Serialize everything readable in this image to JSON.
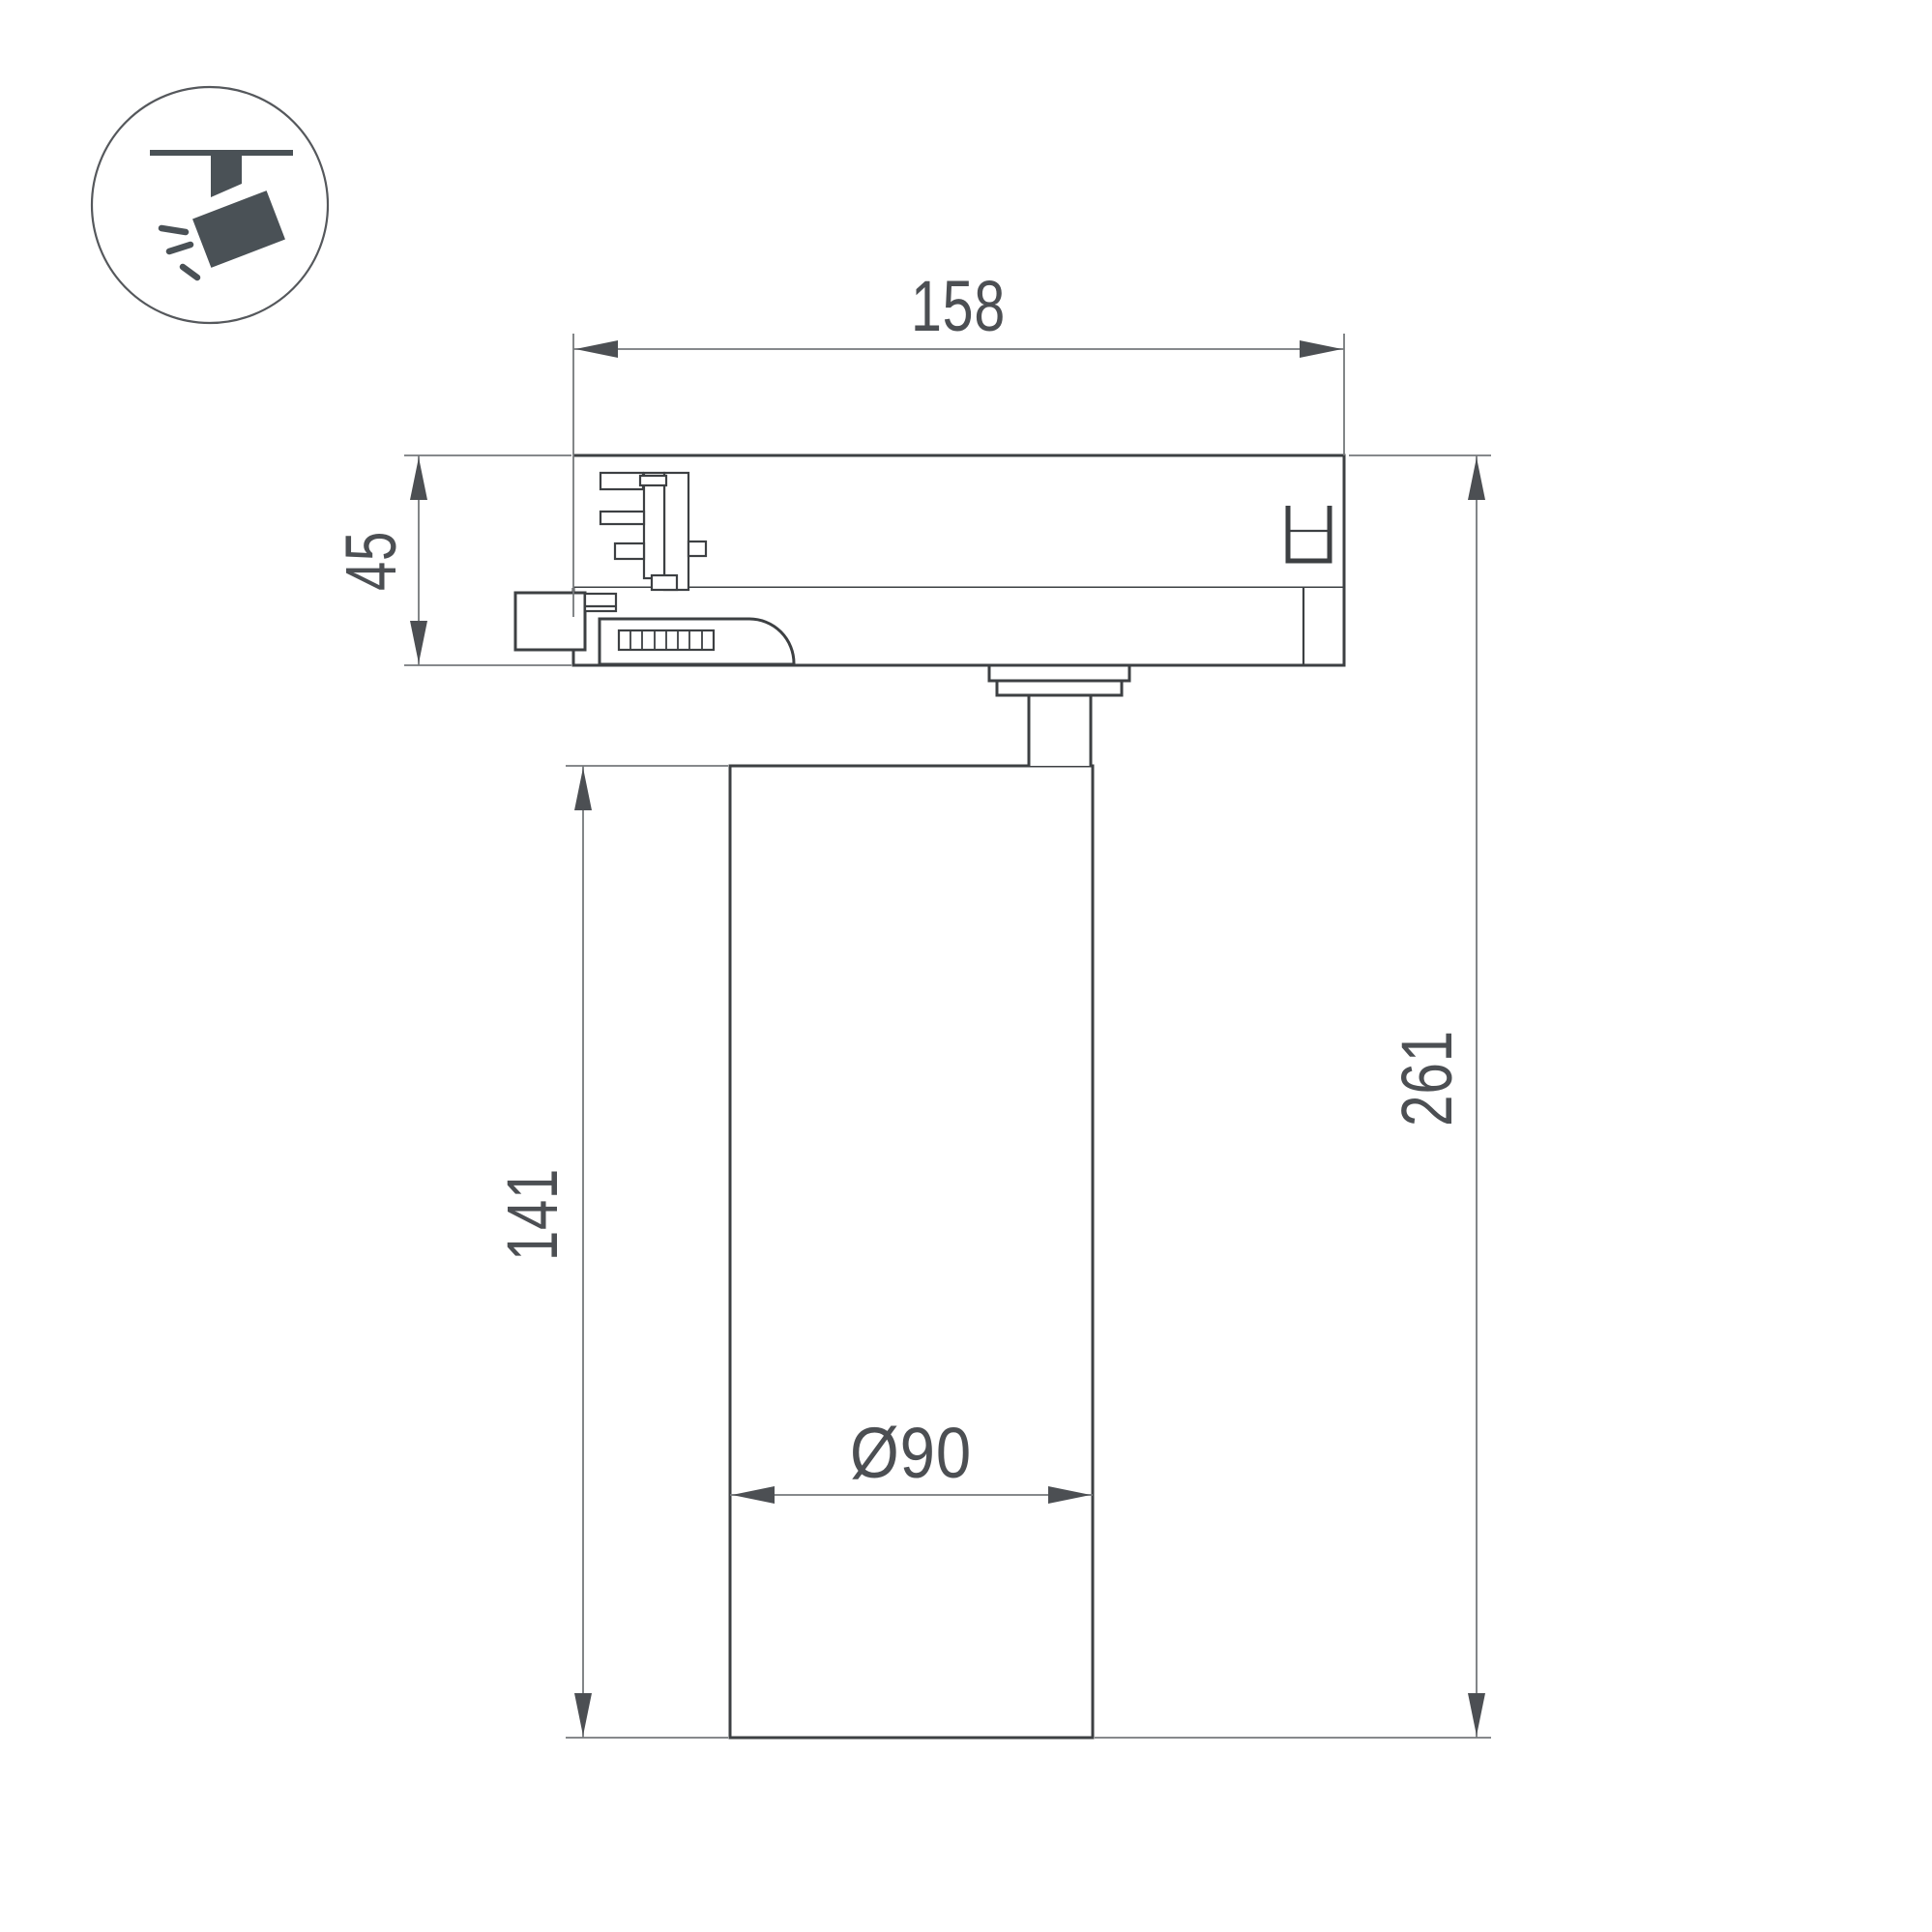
{
  "drawing": {
    "title": "track spotlight dimensional drawing",
    "background": "#ffffff",
    "colors": {
      "object_line": "#3d4043",
      "dimension_line": "#75787b",
      "arrow": "#4c4f53",
      "text": "#4c4f53",
      "icon": "#4a5156",
      "icon_circle": "#55585c"
    },
    "icon": {
      "name": "track-spotlight-icon"
    },
    "dimensions": {
      "adapter_width": "158",
      "adapter_height": "45",
      "body_height": "141",
      "total_height": "261",
      "body_diameter": "Ø90"
    }
  }
}
